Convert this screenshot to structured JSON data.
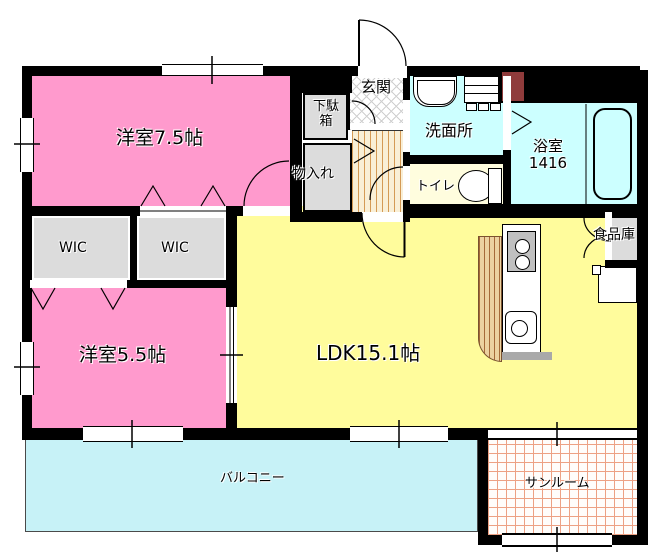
{
  "rooms": {
    "bedroom75": {
      "label": "洋室7.5帖"
    },
    "bedroom55": {
      "label": "洋室5.5帖"
    },
    "ldk": {
      "label": "LDK15.1帖"
    },
    "wic1": {
      "label": "WIC"
    },
    "wic2": {
      "label": "WIC"
    },
    "entrance": {
      "label": "玄関"
    },
    "shoe_cabinet": {
      "label_line1": "下駄",
      "label_line2": "箱"
    },
    "storage": {
      "label": "物入れ"
    },
    "washroom": {
      "label": "洗面所"
    },
    "toilet": {
      "label": "トイレ"
    },
    "bathroom": {
      "label_line1": "浴室",
      "label_line2": "1416"
    },
    "pantry": {
      "label": "食品庫"
    },
    "balcony": {
      "label": "バルコニー"
    },
    "sunroom": {
      "label": "サンルーム"
    }
  },
  "colors": {
    "wall": "#000000",
    "bedroom_pink": "#FF9ACD",
    "ldk_yellow": "#FFFC9C",
    "toilet_cream": "#FFFDDE",
    "wet_area_cyan": "#CCFFFF",
    "balcony_cyan": "#C7F2F7",
    "closet_gray": "#DCDCDC",
    "utility_dark_red": "#8F3B3B",
    "wood_stripe": "#D49A55",
    "sunroom_grid": "#EDA184"
  }
}
